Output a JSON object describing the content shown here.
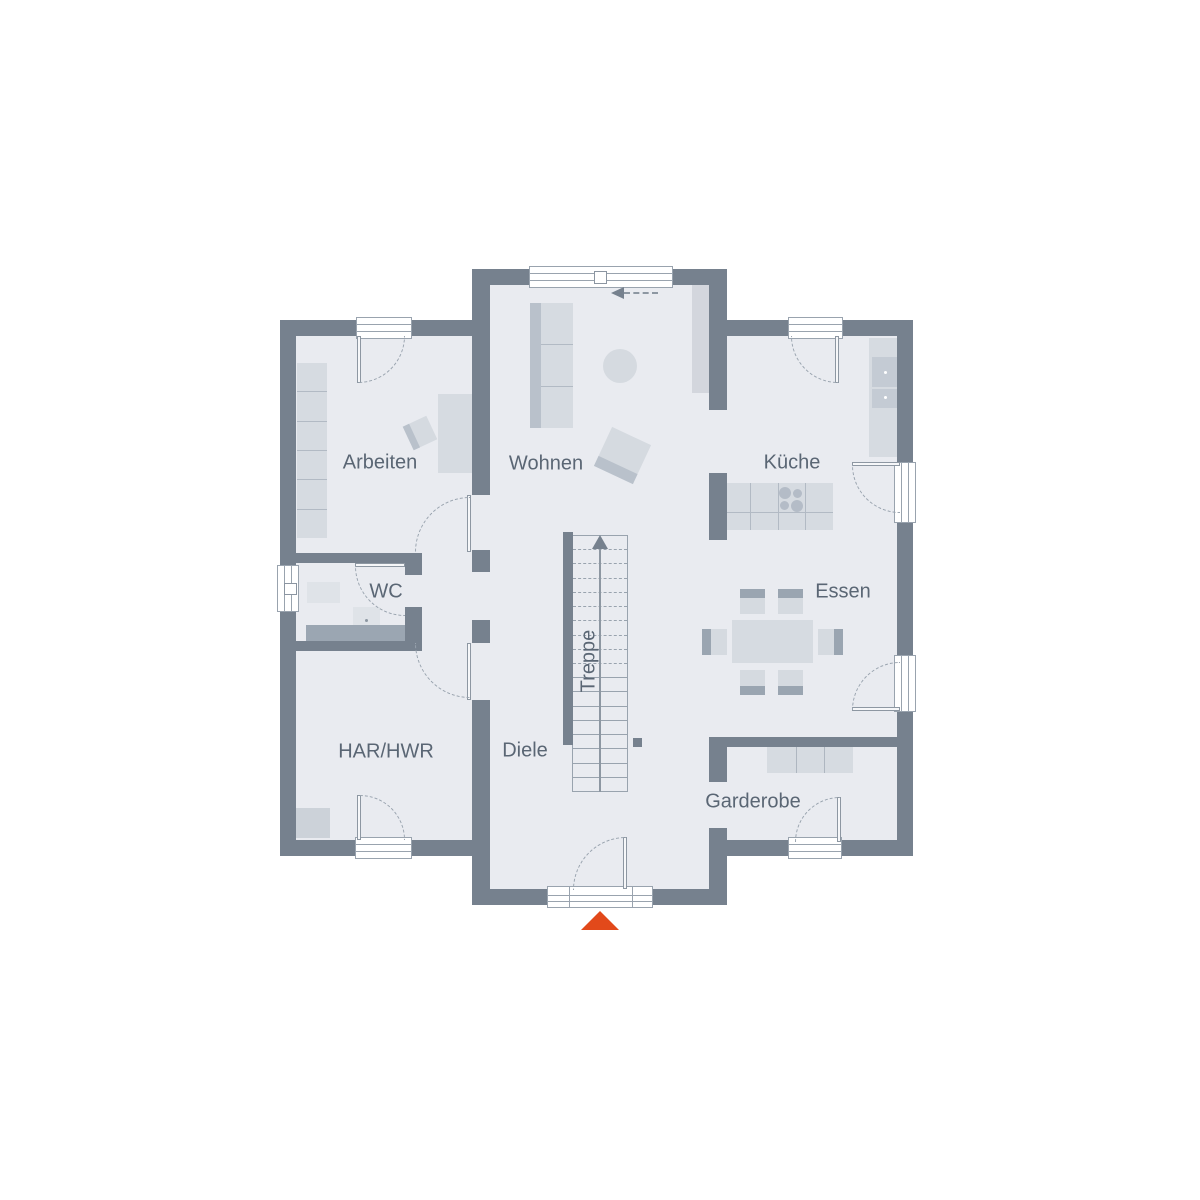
{
  "type": "floor-plan",
  "rooms": {
    "arbeiten": {
      "label": "Arbeiten"
    },
    "wohnen": {
      "label": "Wohnen"
    },
    "kueche": {
      "label": "Küche"
    },
    "wc": {
      "label": "WC"
    },
    "essen": {
      "label": "Essen"
    },
    "har_hwr": {
      "label": "HAR/HWR"
    },
    "diele": {
      "label": "Diele"
    },
    "garderobe": {
      "label": "Garderobe"
    },
    "treppe": {
      "label": "Treppe"
    }
  },
  "colors": {
    "wall": "#76818e",
    "floor": "#e9ebf0",
    "furniture": "#d6dbe1",
    "furniture_accent": "#b9c1cb",
    "outline": "#99a3ae",
    "label_text": "#5a6674",
    "entrance_marker": "#e2491a"
  }
}
